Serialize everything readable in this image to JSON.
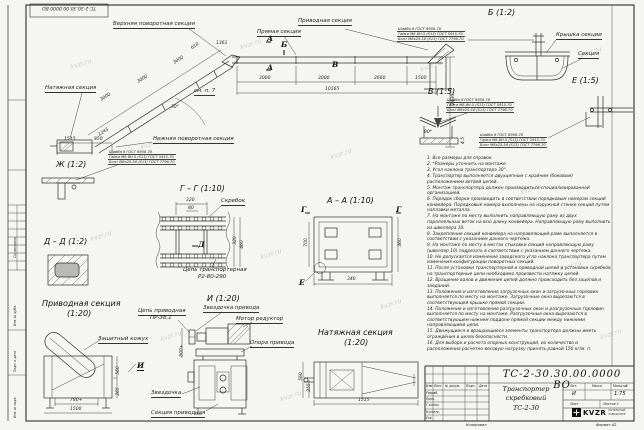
{
  "watermark": "kvzr.ru",
  "stamp_inverted": "ТС-2-30.30.00.0000 ВО",
  "main_view": {
    "labels": {
      "upper_turn": "Верхняя поворотная секция",
      "straight": "Прямая секция",
      "drive": "Приводная секция",
      "tension": "Натяжная секция",
      "lower_turn": "Нижняя поворотная секция",
      "see_note": "см. п. 7"
    },
    "marks": {
      "a": "А",
      "b": "Б",
      "v": "В"
    },
    "dims": {
      "seg1": "3000",
      "seg2": "3000",
      "seg3": "2660",
      "seg4": "1500",
      "total": "10165",
      "height": "1430",
      "inc1": "3000",
      "inc2": "3000",
      "inc3": "3000",
      "inc4": "610",
      "inc5": "1361",
      "angle": "30°",
      "t1": "1515",
      "t2": "850",
      "t3": "1243"
    }
  },
  "fastener_note": {
    "l1": "Шайба 8 ГОСТ 6958-78",
    "l2": "Гайка М8-6Н.5 (S13) ГОСТ 5915-70",
    "l3": "Болт М8х25.58 (S13) ГОСТ 7796-70"
  },
  "views": {
    "b": {
      "title": "Б (1:2)",
      "cover": "Крышка секции",
      "section": "Секция"
    },
    "v": {
      "title": "В (1:5)",
      "dim1": "80*",
      "dim2": "4,5"
    },
    "e": {
      "title": "Е (1:5)"
    },
    "zh": {
      "title": "Ж (1:2)"
    },
    "gg": {
      "title": "Г – Г (1:10)",
      "scraper": "Скребок",
      "chain1": "Цепь транспортерная",
      "chain2": "Р2-80-290",
      "dim1": "320",
      "dim2": "80",
      "dim3": "320",
      "dim4": "460",
      "mark": "Д"
    },
    "dd": {
      "title": "Д – Д (1:2)"
    },
    "aa": {
      "title": "А – А (1:10)",
      "dim1": "340",
      "dim2": "700",
      "dim3": "360",
      "mark_g": "Г",
      "mark_e": "Е"
    },
    "drive": {
      "title": "Приводная секция",
      "scale": "(1:20)",
      "casing": "Защитный кожух",
      "dim1": "780+",
      "dim2": "1500",
      "dim3": "560",
      "dim4": "265",
      "mark": "И"
    },
    "i": {
      "title": "И (1:20)",
      "chain1": "Цепь приводная",
      "chain2": "ПР-38,1",
      "sprocket_drive": "Звездочка привода",
      "motor": "Мотор редуктор",
      "support": "Опора привода",
      "sprocket": "Звездочка",
      "section": "Секция приводная",
      "dim": "800+"
    },
    "tension": {
      "title": "Натяжная секция",
      "scale": "(1:20)",
      "dim1": "1515",
      "dim2": "560",
      "dim3": "255"
    }
  },
  "notes": [
    "1. Все размеры для справок.",
    "2. *Размеры уточнить на монтаже.",
    "3. Угол наклона транспортера 30°.",
    "4. Транспортер выполняется двухцепным с крайним (боковым) расположением ветвей цепей.",
    "5. Монтаж транспортера должен производиться специализированной организацией.",
    "6. Порядок сборки производить в соответствии порядковым номерам секций конвейера. Порядковые номера выполнены на наружной стенке секций путем наплавки металла.",
    "7. На монтаже по месту выполнить направляющую раму из двух параллельных веток на всю длину конвейера. Направляющую раму выполнить из швеллера 10.",
    "8. Закрепление секций конвейера на направляющей раме выполняется в соответствии с указанием данного чертежа.",
    "9. На монтаже по месту в местах стыковки секций направляющую раму (швеллер 10) подрезать в соответствии с указанием данного чертежа.",
    "10. Не допускается изменение заводского угла наклона транспортера путем изменения конфигурации поворотных секций.",
    "11. После установки транспортерной и приводной цепей и установки скребков на транспортерные цепи необходимо произвести натяжку цепей.",
    "12. Вращение валов и движение цепей должно происходить без зацепов и заеданий.",
    "13. Положения и изготовления загрузочных окон и загрузочных горловин выполняется по месту на монтаже. Загрузочные окна вырезаются в соответствующей крышке прямой секции.",
    "14. Положения и изготовления разгрузочных окон и разгрузочных горловин выполняется по месту на монтаже. Разгрузочные окна вырезаются в соответствующем нижнем поддоне прямой секции между нижними направляющими цепи.",
    "15. Движущиеся и вращающиеся элементы транспортера должны иметь ограждения в целях безопасности.",
    "16. Для выбора и расчета опорных конструкций, их количество и расположения расчетно-весовую нагрузку принять равной 150 кг/м. п."
  ],
  "title_block": {
    "doc_number": "ТС-2-30.30.00.0000 ВО",
    "name1": "Транспортер",
    "name2": "скребковый",
    "name3": "ТС-2-30",
    "header_cols": [
      "Изм.",
      "Лист",
      "№ докум.",
      "Подп.",
      "Дата"
    ],
    "rows": [
      "Разраб.",
      "Пров.",
      "Т.контр.",
      "Н.контр.",
      "Утв."
    ],
    "lit_header": "Лит.",
    "mass_header": "Масса",
    "scale_header": "Масштаб",
    "lit": "И",
    "scale": "1:75",
    "sheet": "Лист",
    "sheets": "Листов 1",
    "logo": "KVZR",
    "logo_sub1": "КОТЕЛЬНЫЙ",
    "logo_sub2": "ЗАВОД КВЗР",
    "copied": "Копировал",
    "format": "Формат А2"
  },
  "side_strip": {
    "s1": "Согласовано",
    "s2": "Инв. № дубл.",
    "s3": "Подп. и дата",
    "s4": "Инв. № подл."
  }
}
